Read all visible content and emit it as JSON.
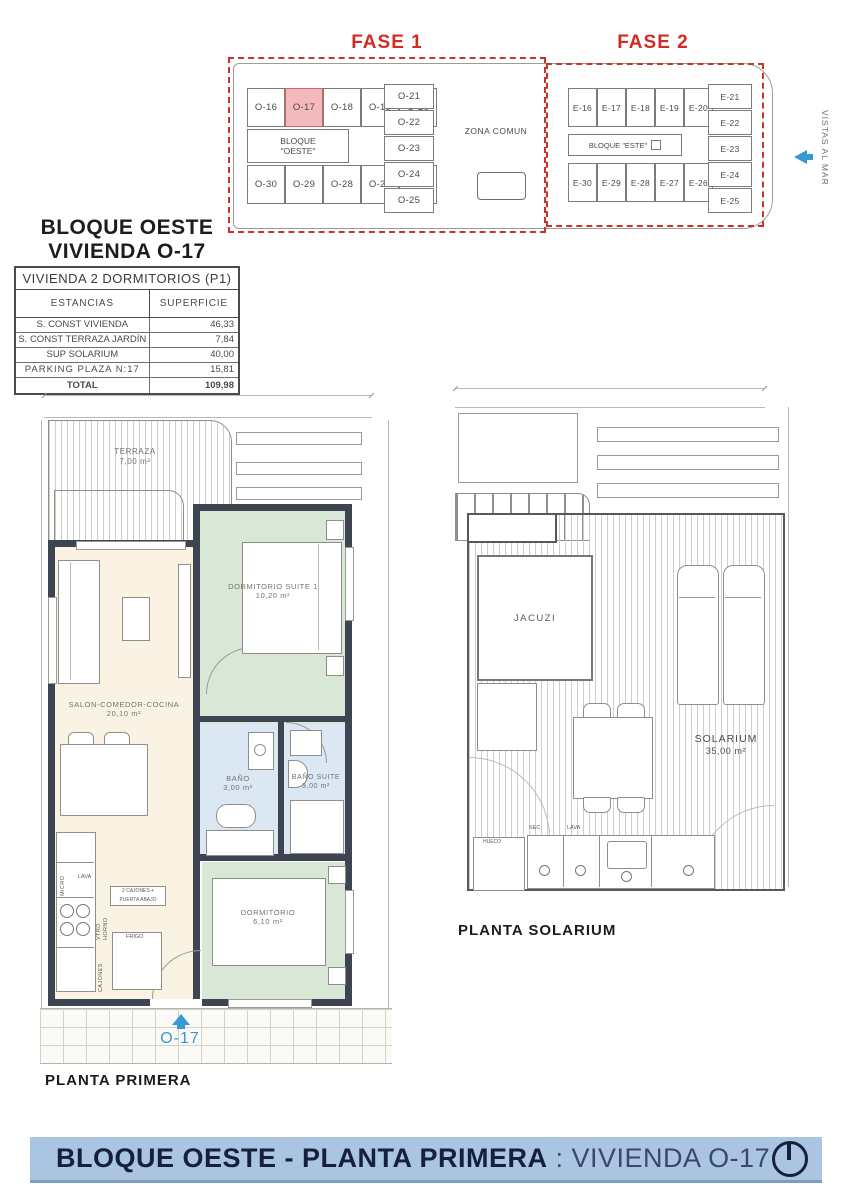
{
  "site_plan": {
    "fase1": {
      "title": "FASE 1",
      "block_label_line1": "BLOQUE",
      "block_label_line2": "\"OESTE\"",
      "top_units": [
        "O-16",
        "O-17",
        "O-18",
        "O-19",
        "O-20"
      ],
      "bottom_units": [
        "O-30",
        "O-29",
        "O-28",
        "O-27",
        "O-26"
      ],
      "stack_units": [
        "O-21",
        "O-22",
        "O-23",
        "O-24",
        "O-25"
      ],
      "highlighted_unit": "O-17",
      "zona_comun_label": "ZONA COMUN"
    },
    "fase2": {
      "title": "FASE 2",
      "block_label": "BLOQUE \"ESTE\"",
      "top_units": [
        "E-16",
        "E-17",
        "E-18",
        "E-19",
        "E-20"
      ],
      "bottom_units": [
        "E-30",
        "E-29",
        "E-28",
        "E-27",
        "E-26"
      ],
      "stack_units": [
        "E-21",
        "E-22",
        "E-23",
        "E-24",
        "E-25"
      ]
    },
    "vistas_al_mar": "VISTAS AL MAR",
    "colors": {
      "phase_border": "#c8342c",
      "highlight": "#f4b9bc",
      "accent_blue": "#3699d2"
    }
  },
  "header": {
    "title_line1": "BLOQUE OESTE",
    "title_line2": "VIVIENDA O-17"
  },
  "table": {
    "title": "VIVIENDA 2 DORMITORIOS (P1)",
    "col_estancias": "ESTANCIAS",
    "col_superficie": "SUPERFICIE",
    "rows": [
      {
        "name": "S. CONST VIVIENDA",
        "value": "46,33"
      },
      {
        "name": "S. CONST TERRAZA JARDÍN",
        "value": "7,84"
      },
      {
        "name": "SUP SOLARIUM",
        "value": "40,00"
      },
      {
        "name": "PARKING PLAZA N:17",
        "value": "15,81"
      }
    ],
    "total_label": "TOTAL",
    "total_value": "109,98"
  },
  "planta_primera": {
    "label": "PLANTA PRIMERA",
    "rooms": {
      "terraza": {
        "name": "TERRAZA",
        "area": "7,00 m²"
      },
      "salon": {
        "name": "SALON-COMEDOR-COCINA",
        "area": "20,10 m²"
      },
      "suite": {
        "name": "DORMITORIO SUITE 1",
        "area": "10,20 m²"
      },
      "bano": {
        "name": "BAÑO",
        "area": "3,00 m²"
      },
      "bano_suite": {
        "name": "BAÑO SUITE",
        "area": "3,00 m²"
      },
      "dormitorio": {
        "name": "DORMITORIO",
        "area": "6,10 m²"
      }
    },
    "kitchen": {
      "micro": "MICRO",
      "lava": "LAVA",
      "vtro": "VTRO",
      "horno": "HORNO",
      "cajones": "CAJONES",
      "frigo": "FRIGO",
      "note_line1": "2 CAJONES +",
      "note_line2": "PUERTA ABAJO"
    },
    "entrance_unit": "O-17"
  },
  "planta_solarium": {
    "label": "PLANTA SOLARIUM",
    "jacuzi": "JACUZI",
    "solarium_name": "SOLARIUM",
    "solarium_area": "35,00 m²",
    "sec": "SEC",
    "lava": "LAVA",
    "hueco": "HUECO"
  },
  "footer": {
    "title_bold": "BLOQUE OESTE - PLANTA PRIMERA",
    "title_regular": ": VIVIENDA O-17",
    "bg_color": "#a9c5e2"
  }
}
